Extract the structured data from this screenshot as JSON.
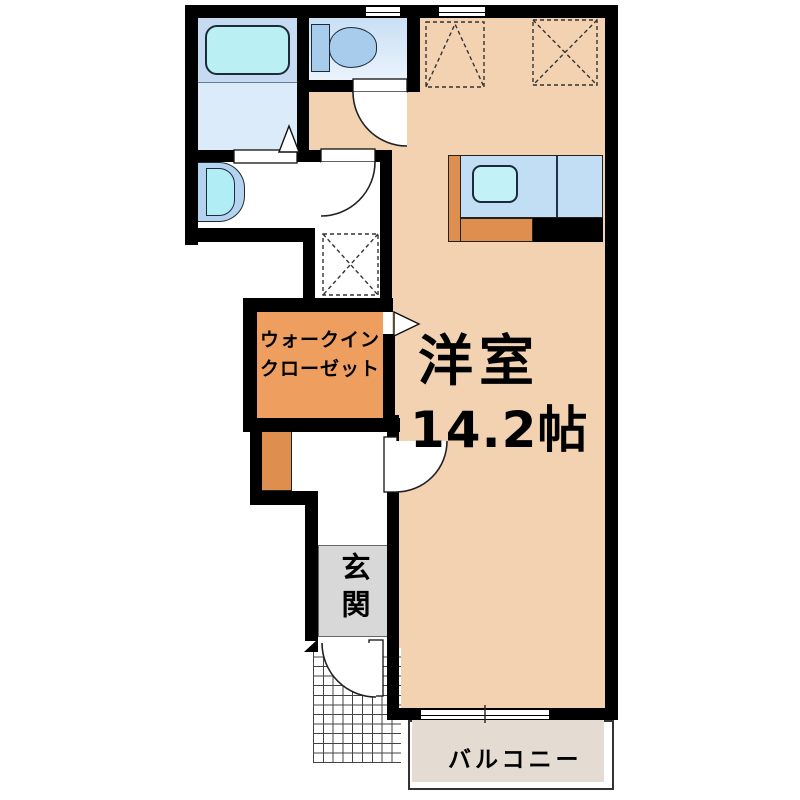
{
  "floor_plan": {
    "kind": "apartment-floor-plan",
    "rooms": {
      "main_room": {
        "label": "洋室",
        "size": "14.2帖"
      },
      "walk_in_closet": {
        "label_line1": "ウォークイン",
        "label_line2": "クローゼット"
      },
      "entrance": {
        "label": "玄関"
      },
      "balcony": {
        "label": "バルコニー"
      }
    },
    "fixtures": [
      "bathtub",
      "toilet",
      "washbasin",
      "kitchen-counter",
      "kitchen-sink",
      "washing-machine-space",
      "entrance-porch-tiles",
      "sliding-window",
      "hinged-doors"
    ],
    "colors": {
      "wall": "#000000",
      "main_room": "#f3d2b2",
      "walk_in_closet": "#ee9f60",
      "cabinet_orange": "#de8f50",
      "entrance_gray": "#d8d8d8",
      "balcony": "#e4dcd2",
      "water_area_blue": "#c6dbf1",
      "fixture_cyan": "#baeff4",
      "counter_blue": "#c2def5"
    }
  }
}
